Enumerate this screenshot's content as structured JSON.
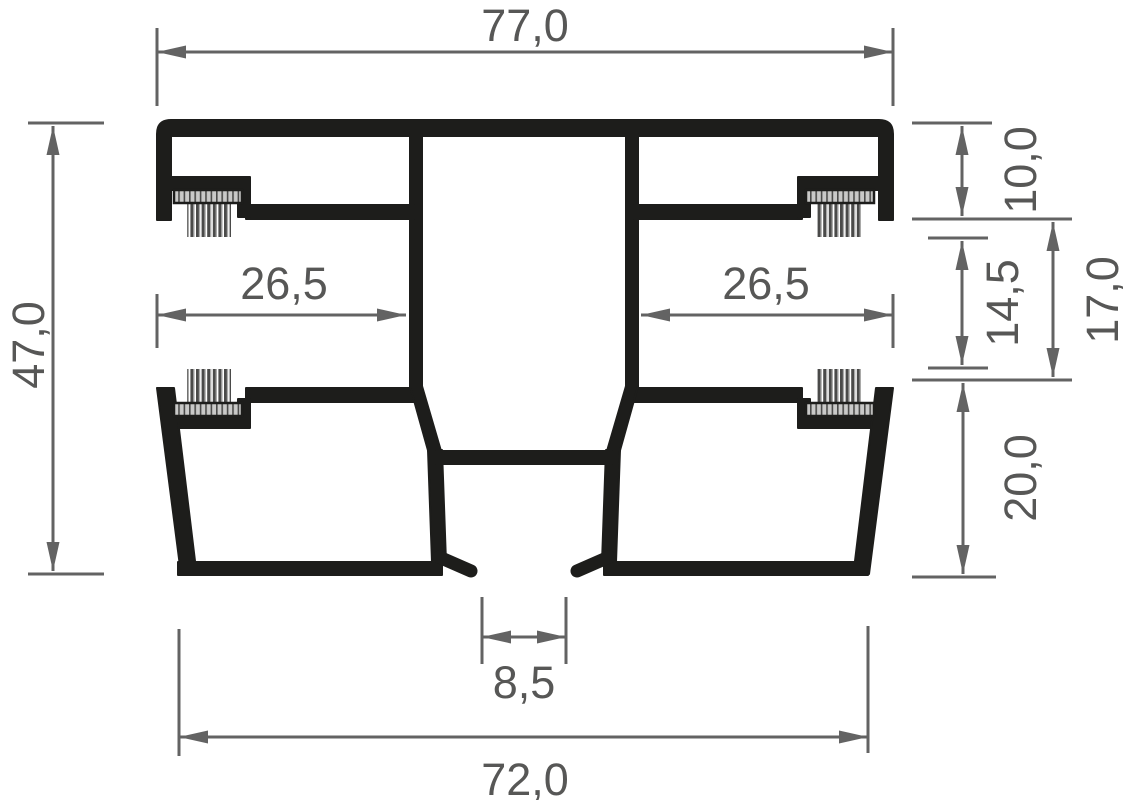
{
  "drawing": {
    "description": "Technical cross-section drawing of a sliding-frame aluminium profile with four brush seals and dimension annotations",
    "dimensions": {
      "top_width": "77,0",
      "overall_height": "47,0",
      "left_track_width": "26,5",
      "right_track_width": "26,5",
      "upper_section_height": "10,0",
      "track_opening_height": "14,5",
      "mid_section_height": "17,0",
      "lower_section_height": "20,0",
      "bottom_gap_width": "8,5",
      "bottom_width": "72,0"
    },
    "colors": {
      "profile": "#1d1d1b",
      "dimension_lines": "#636363",
      "label_text": "#575756",
      "brush_base_fill": "#c9c9c8",
      "brush_strand_dark": "#4a4a49",
      "background": "#ffffff"
    }
  }
}
